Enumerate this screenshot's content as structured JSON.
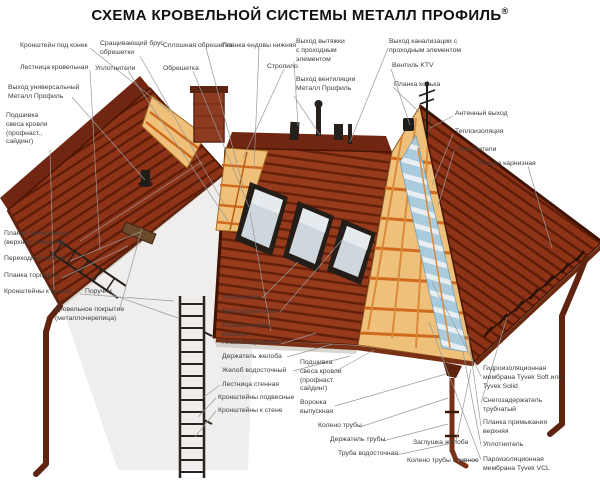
{
  "title": "СХЕМА КРОВЕЛЬНОЙ СИСТЕМЫ МЕТАЛЛ ПРОФИЛЬ",
  "registered_mark": "®",
  "colors": {
    "roof_tile": "#8d3317",
    "roof_shadow": "#5e1d08",
    "insulation": "#eec07a",
    "battens": "#cf6a1e",
    "membrane_blue": "#a9cbdc",
    "wall": "#efeeec",
    "leader_line": "#999999",
    "label_text": "#3d3d3d",
    "title_text": "#111111"
  },
  "labels": [
    {
      "text": "Кронштейн под конек"
    },
    {
      "text": "Лестница кровельная"
    },
    {
      "text": "Выход универсальный\nМеталл Профиль"
    },
    {
      "text": "Подшивка\nсвеса кровли\n(профнаст.,\nсайдинг)"
    },
    {
      "text": "Сращивающий брус\nобрешетки"
    },
    {
      "text": "Уплотнители"
    },
    {
      "text": "Сплошная обрешетка"
    },
    {
      "text": "Обрешетка"
    },
    {
      "text": "Планка ендовы нижняя"
    },
    {
      "text": "Стропило"
    },
    {
      "text": "Выход вытяжки\nс проходным\nэлементом"
    },
    {
      "text": "Выход вентиляции\nМеталл Профиль"
    },
    {
      "text": "Выход канализации с\nпроходным элементом"
    },
    {
      "text": "Вентиль KTV"
    },
    {
      "text": "Планка конька"
    },
    {
      "text": "Антенный выход"
    },
    {
      "text": "Теплоизоляция"
    },
    {
      "text": "Уплотнители"
    },
    {
      "text": "Планка карнизная"
    },
    {
      "text": "Планка примыкания\n(верхняя и нижняя)"
    },
    {
      "text": "Переходной мостик"
    },
    {
      "text": "Планка торцевая"
    },
    {
      "text": "Кронштейны к крыше"
    },
    {
      "text": "Поручни"
    },
    {
      "text": "Кровельное покрытие\n(металлочерепица)"
    },
    {
      "text": "Уплотнитель"
    },
    {
      "text": "Мансардное окно"
    },
    {
      "text": "Планка ендовы\nверхняя"
    },
    {
      "text": "Планка карнизная"
    },
    {
      "text": "Держатель желоба"
    },
    {
      "text": "Желоб водосточный"
    },
    {
      "text": "Лестница стенная"
    },
    {
      "text": "Кронштейны подвесные"
    },
    {
      "text": "Кронштейны к стене"
    },
    {
      "text": "Подшивка\nсвеса кровли\n(профнаст.\nсайдинг)"
    },
    {
      "text": "Воронка\nвыпускная"
    },
    {
      "text": "Колено трубы"
    },
    {
      "text": "Держатель трубы"
    },
    {
      "text": "Труба водосточная"
    },
    {
      "text": "Заглушка желоба"
    },
    {
      "text": "Колено трубы сливное"
    },
    {
      "text": "Гидроизоляционная\nмембрана Tyvek Soft или\nTyvek Solid"
    },
    {
      "text": "Снегозадержатель\nтрубчатый"
    },
    {
      "text": "Планка примыкания\nверхняя"
    },
    {
      "text": "Уплотнитель"
    },
    {
      "text": "Пароизоляционная\nмембрана Tyvek VCL"
    }
  ]
}
